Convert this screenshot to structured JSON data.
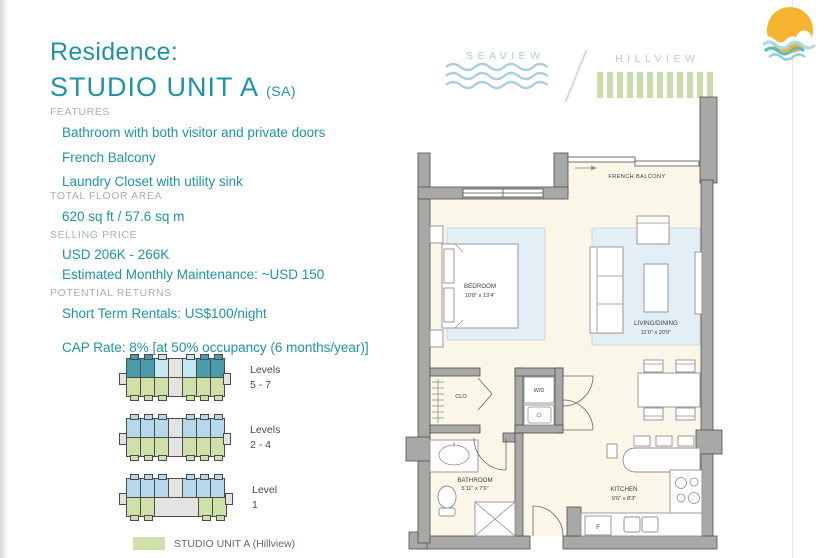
{
  "theme": {
    "teal": "#1f93a3",
    "muted_label": "#a3b2bd",
    "wall": "#a8a8a6",
    "wall_stroke": "#4e4e4c",
    "floor": "#faf7e9",
    "rug": "#e3eef6",
    "furniture_stroke": "#8f8f8d",
    "plan_text": "#3d3d3b",
    "brand_blue": "#aacfe2",
    "brand_green": "#c9dcab",
    "sun_yellow": "#f5b32f",
    "unit_teal": "#4a9cac",
    "unit_cyan": "#c3e9f0",
    "unit_blue": "#b7d8eb",
    "unit_green": "#cfe0a8",
    "core_gray": "#e3e3e1"
  },
  "header": {
    "title_line1": "Residence:",
    "title_line2": "STUDIO UNIT A",
    "title_suffix": "(SA)"
  },
  "brand": {
    "left": "SEAVIEW",
    "right": "HILLVIEW"
  },
  "sections": {
    "features": {
      "label": "FEATURES",
      "items": [
        "Bathroom with both visitor and private doors",
        "French Balcony",
        "Laundry Closet with utility sink"
      ]
    },
    "floor_area": {
      "label": "TOTAL FLOOR AREA",
      "value": "620 sq ft / 57.6 sq m"
    },
    "selling_price": {
      "label": "SELLING PRICE",
      "line1": "USD 206K - 266K",
      "line2": "Estimated Monthly Maintenance: ~USD 150"
    },
    "returns": {
      "label": "POTENTIAL RETURNS",
      "line1": "Short Term Rentals: US$100/night",
      "line2": "CAP Rate: 8% [at 50% occupancy (6 months/year)]"
    }
  },
  "buildings": [
    {
      "label_line1": "Levels",
      "label_line2": "5 - 7",
      "top": [
        "teal",
        "teal",
        "cyan",
        "core",
        "cyan",
        "teal",
        "teal"
      ],
      "bottom": [
        "green",
        "green",
        "green",
        "core",
        "green",
        "green",
        "green"
      ]
    },
    {
      "label_line1": "Levels",
      "label_line2": "2 - 4",
      "top": [
        "blue",
        "blue",
        "blue",
        "core",
        "blue",
        "blue",
        "blue"
      ],
      "bottom": [
        "green",
        "green",
        "green",
        "core",
        "green",
        "green",
        "green"
      ]
    },
    {
      "label_line1": "Level",
      "label_line2": "1",
      "top": [
        "blue",
        "blue",
        "blue",
        "core",
        "blue",
        "blue",
        "blue"
      ],
      "bottom": [
        "green",
        "green",
        "lobby3",
        "green",
        "green"
      ]
    }
  ],
  "legend": {
    "label": "STUDIO UNIT A (Hillview)"
  },
  "floorplan": {
    "french_balcony": "FRENCH BALCONY",
    "bedroom_name": "BEDROOM",
    "bedroom_dims": "10'8\" x 13'4\"",
    "living_name": "LIVING/DINING",
    "living_dims": "11'0\" x 20'9\"",
    "closet": "CLO",
    "washer": "W/D",
    "bathroom_name": "BATHROOM",
    "bathroom_dims": "5'11\" x 7'6\"",
    "kitchen_name": "KITCHEN",
    "kitchen_dims": "9'6\" x 8'3\"",
    "fridge": "F"
  }
}
